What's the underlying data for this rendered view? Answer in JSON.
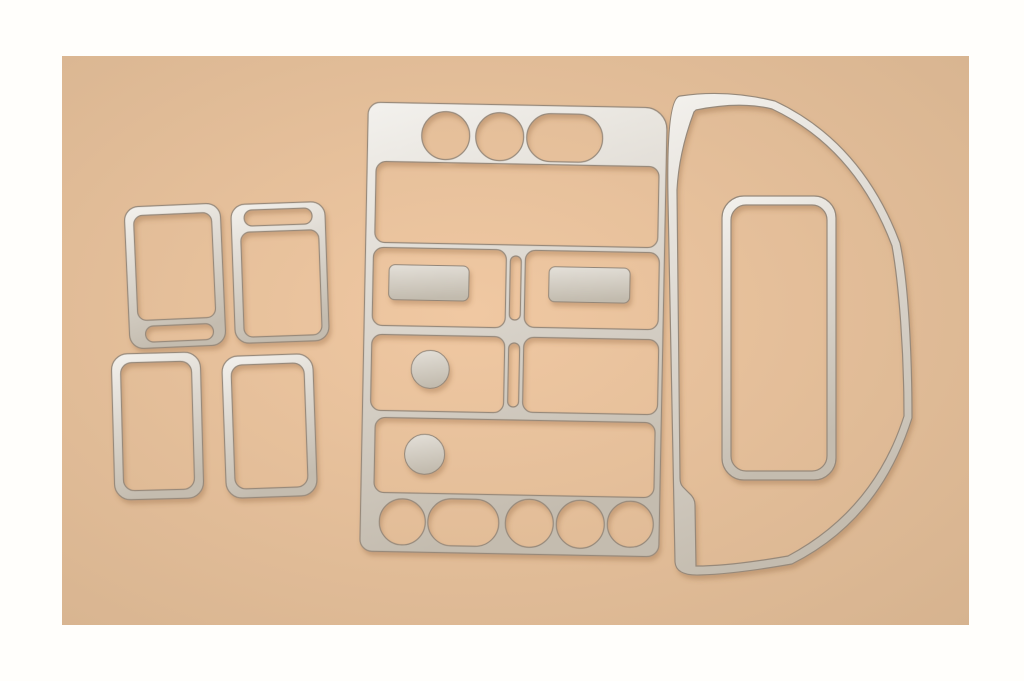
{
  "image": {
    "type": "product-photo",
    "subject": "Car interior dash trim kit with eight brushed-aluminum pieces laid out on a peach backdrop",
    "text_content": "none"
  },
  "colors": {
    "page_bg": "#fffefb",
    "backdrop_center": "#f0c8a2",
    "backdrop_edge": "#d6b38f",
    "metal_highlight": "#f3f1ed",
    "metal_mid": "#ddd8d0",
    "metal_shadow": "#c4bcaf",
    "insert_light": "#e4e0d9",
    "insert_dark": "#c2bbae",
    "edge_line": "#97897a",
    "cast_shadow": "#8a5f38"
  },
  "pieces": [
    {
      "id": "bezel-upper-left",
      "name": "switch bezel, slot at bottom"
    },
    {
      "id": "bezel-upper-right",
      "name": "switch bezel, slot at top"
    },
    {
      "id": "bezel-lower-left",
      "name": "plain rectangular bezel"
    },
    {
      "id": "bezel-lower-right",
      "name": "plain rectangular bezel"
    },
    {
      "id": "center-console",
      "name": "center console radio and HVAC panel with circular and rectangular cutouts"
    },
    {
      "id": "console-inserts",
      "name": "two rectangular button inserts and two round knob covers"
    },
    {
      "id": "side-outline",
      "name": "large curved side-dash outline trim"
    },
    {
      "id": "inner-frame",
      "name": "tall rounded rectangular frame"
    }
  ]
}
